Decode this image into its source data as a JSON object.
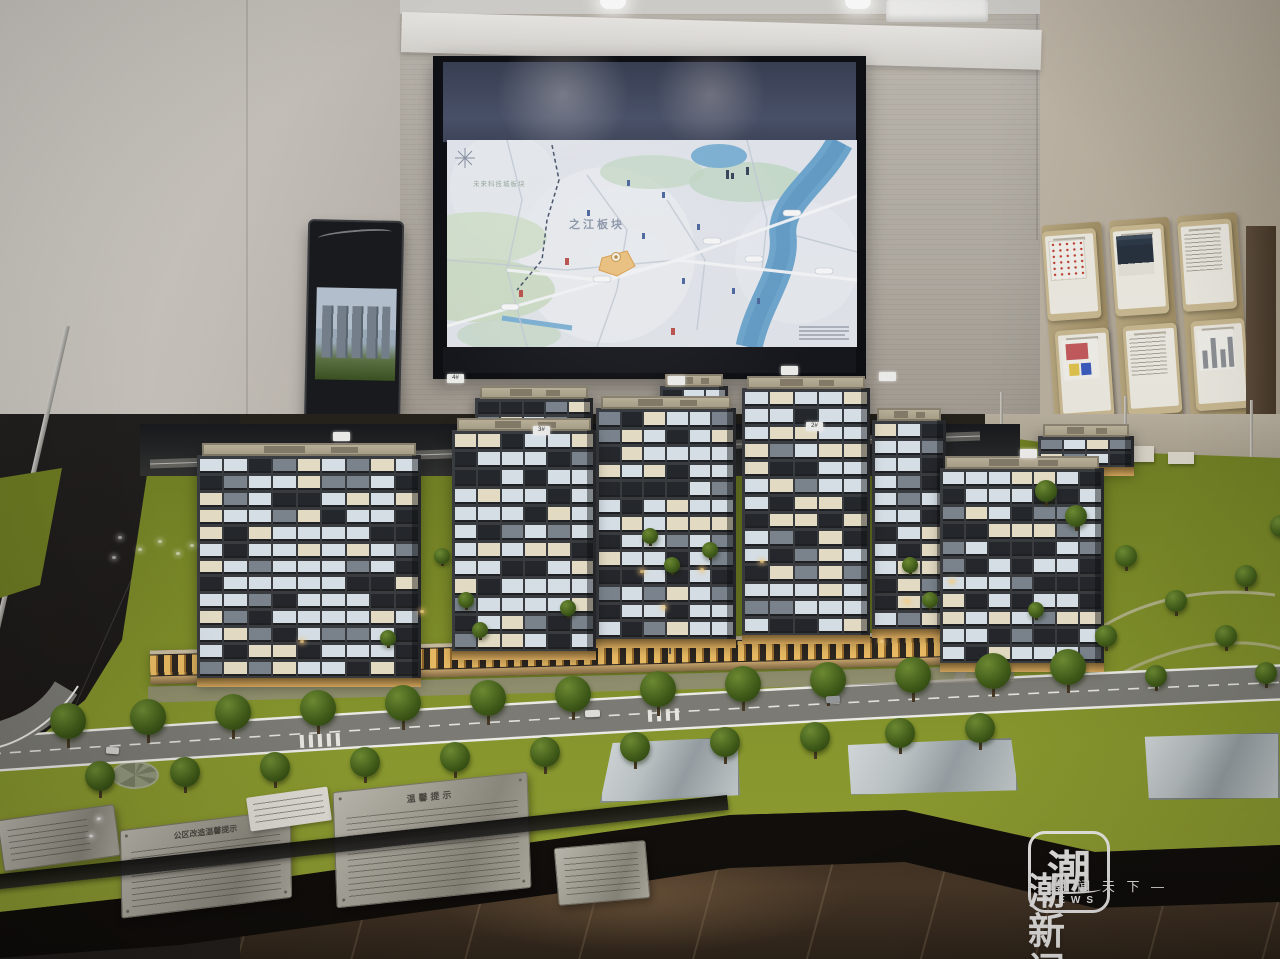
{
  "screen_map": {
    "district_label_primary": "之江板块",
    "district_label_secondary": "未来科技城板块"
  },
  "model": {
    "building_tags": [
      "",
      "4#",
      "3#",
      "",
      "",
      "2#",
      "",
      ""
    ],
    "plaque_left_title": "公区改造温馨提示",
    "plaque_right_title": "温馨提示"
  },
  "watermark": {
    "logo_character": "潮",
    "logo_caption": "NEWS",
    "brand_name": "潮新闻",
    "tagline": "— 潮 闻 天 下 —"
  }
}
